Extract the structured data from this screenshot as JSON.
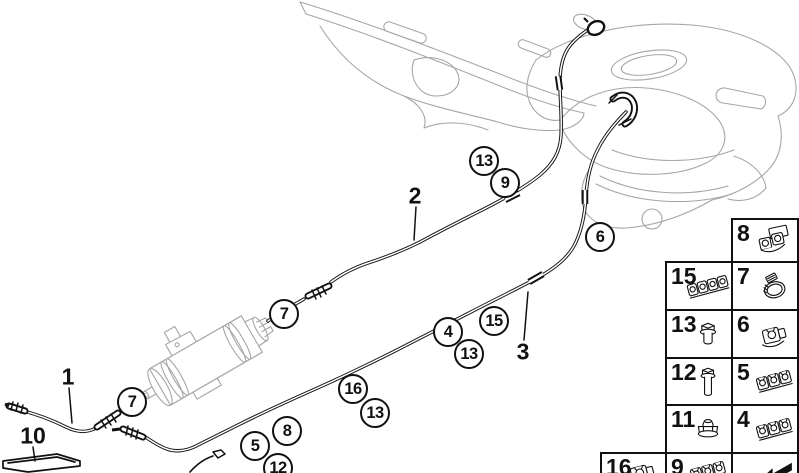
{
  "diagram": {
    "type": "parts-diagram",
    "subject": "fuel-pipes-and-mounting-parts",
    "colors": {
      "line": "#111111",
      "faded_art": "#a6a6a6",
      "background": "#ffffff"
    },
    "callouts": [
      {
        "label": "13",
        "x": 484,
        "y": 161
      },
      {
        "label": "9",
        "x": 505,
        "y": 183
      },
      {
        "label": "6",
        "x": 600,
        "y": 237
      },
      {
        "label": "7",
        "x": 284,
        "y": 314
      },
      {
        "label": "15",
        "x": 494,
        "y": 321
      },
      {
        "label": "4",
        "x": 448,
        "y": 332
      },
      {
        "label": "13",
        "x": 469,
        "y": 354
      },
      {
        "label": "7",
        "x": 132,
        "y": 402
      },
      {
        "label": "16",
        "x": 353,
        "y": 389
      },
      {
        "label": "13",
        "x": 375,
        "y": 413
      },
      {
        "label": "8",
        "x": 287,
        "y": 431
      },
      {
        "label": "5",
        "x": 255,
        "y": 446
      },
      {
        "label": "12",
        "x": 278,
        "y": 468
      }
    ],
    "ref_labels": [
      {
        "text": "2",
        "x": 415,
        "y": 196
      },
      {
        "text": "3",
        "x": 523,
        "y": 352
      },
      {
        "text": "1",
        "x": 68,
        "y": 377
      },
      {
        "text": "10",
        "x": 33,
        "y": 436
      }
    ]
  },
  "legend": {
    "cells": [
      {
        "num": "8",
        "icon": "double-pipe-clip",
        "x": 731,
        "y": 218,
        "w": 68,
        "h": 45
      },
      {
        "num": "15",
        "icon": "clip-rail-4",
        "x": 665,
        "y": 261,
        "w": 68,
        "h": 50
      },
      {
        "num": "7",
        "icon": "hose-clamp",
        "x": 731,
        "y": 261,
        "w": 68,
        "h": 50
      },
      {
        "num": "13",
        "icon": "flange-bolt-short",
        "x": 665,
        "y": 309,
        "w": 68,
        "h": 50
      },
      {
        "num": "6",
        "icon": "pipe-clip",
        "x": 731,
        "y": 309,
        "w": 68,
        "h": 50
      },
      {
        "num": "12",
        "icon": "flange-bolt-long",
        "x": 665,
        "y": 357,
        "w": 68,
        "h": 49
      },
      {
        "num": "5",
        "icon": "clip-rail-3",
        "x": 731,
        "y": 357,
        "w": 68,
        "h": 49
      },
      {
        "num": "11",
        "icon": "cap-nut",
        "x": 665,
        "y": 404,
        "w": 68,
        "h": 50
      },
      {
        "num": "4",
        "icon": "clip-rail-3",
        "x": 731,
        "y": 404,
        "w": 68,
        "h": 50
      },
      {
        "num": "16",
        "icon": "pipe-clip",
        "x": 600,
        "y": 452,
        "w": 67,
        "h": 40
      },
      {
        "num": "9",
        "icon": "clip-rail-3",
        "x": 665,
        "y": 452,
        "w": 68,
        "h": 40
      },
      {
        "num": "",
        "icon": "direction-arrow",
        "x": 731,
        "y": 452,
        "w": 68,
        "h": 40
      }
    ]
  }
}
